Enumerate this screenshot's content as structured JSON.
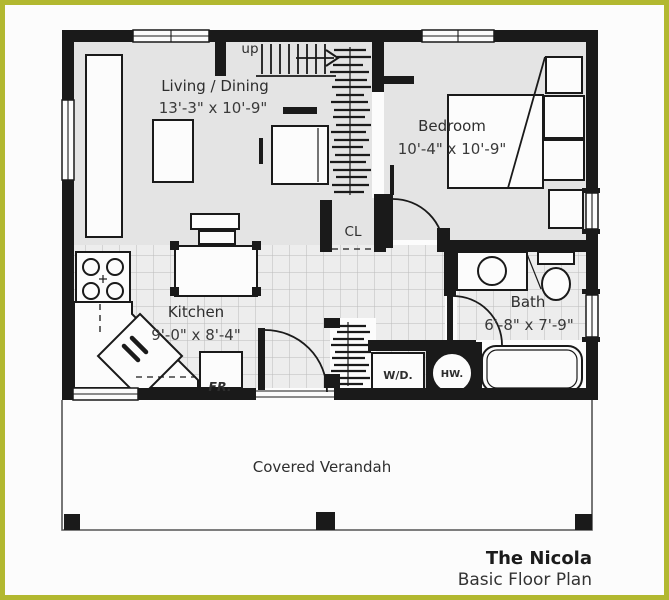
{
  "title_block": {
    "name": "The Nicola",
    "subtitle": "Basic Floor Plan"
  },
  "rooms": {
    "living_dining": {
      "label": "Living / Dining",
      "dimensions": "13'-3\" x 10'-9\""
    },
    "bedroom": {
      "label": "Bedroom",
      "dimensions": "10'-4\" x 10'-9\""
    },
    "kitchen": {
      "label": "Kitchen",
      "dimensions": "9'-0\" x 8'-4\""
    },
    "bath": {
      "label": "Bath",
      "dimensions": "6'-8\" x 7'-9\""
    },
    "closet": {
      "label": "CL"
    },
    "verandah": {
      "label": "Covered Verandah"
    }
  },
  "labels": {
    "stairs": "up",
    "washer_dryer": "W/D.",
    "hot_water": "HW.",
    "fridge": "FR."
  },
  "colors": {
    "frame": "#b2b830",
    "ink": "#1a1a1a",
    "shade": "#e4e4e4",
    "tile": "#ededed",
    "tile-line": "#bcbcbc",
    "paper": "#fcfcfc",
    "text": "#2e2e2e"
  }
}
